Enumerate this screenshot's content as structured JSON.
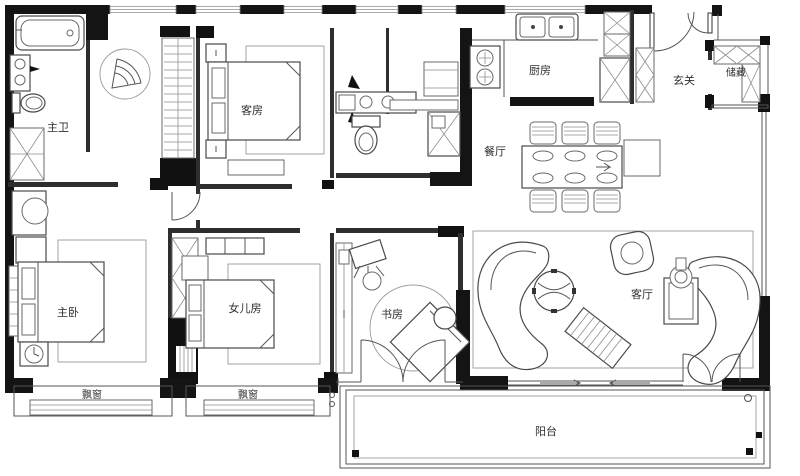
{
  "plan": {
    "type": "apartment-floor-plan",
    "rooms": [
      {
        "id": "master-bath",
        "label": "主卫"
      },
      {
        "id": "guest-room",
        "label": "客房"
      },
      {
        "id": "kitchen",
        "label": "厨房"
      },
      {
        "id": "entry",
        "label": "玄关"
      },
      {
        "id": "storage",
        "label": "储藏"
      },
      {
        "id": "dining",
        "label": "餐厅"
      },
      {
        "id": "master-bedroom",
        "label": "主卧"
      },
      {
        "id": "daughter-room",
        "label": "女儿房"
      },
      {
        "id": "study",
        "label": "书房"
      },
      {
        "id": "living-room",
        "label": "客厅"
      },
      {
        "id": "bay-window-master",
        "label": "飘窗"
      },
      {
        "id": "bay-window-daughter",
        "label": "飘窗"
      },
      {
        "id": "balcony",
        "label": "阳台"
      }
    ],
    "colors": {
      "wall": "#141414",
      "interior_wall": "#2e2e2e",
      "line": "#4a4a4a",
      "background": "#ffffff",
      "text": "#2f2f2f"
    }
  }
}
